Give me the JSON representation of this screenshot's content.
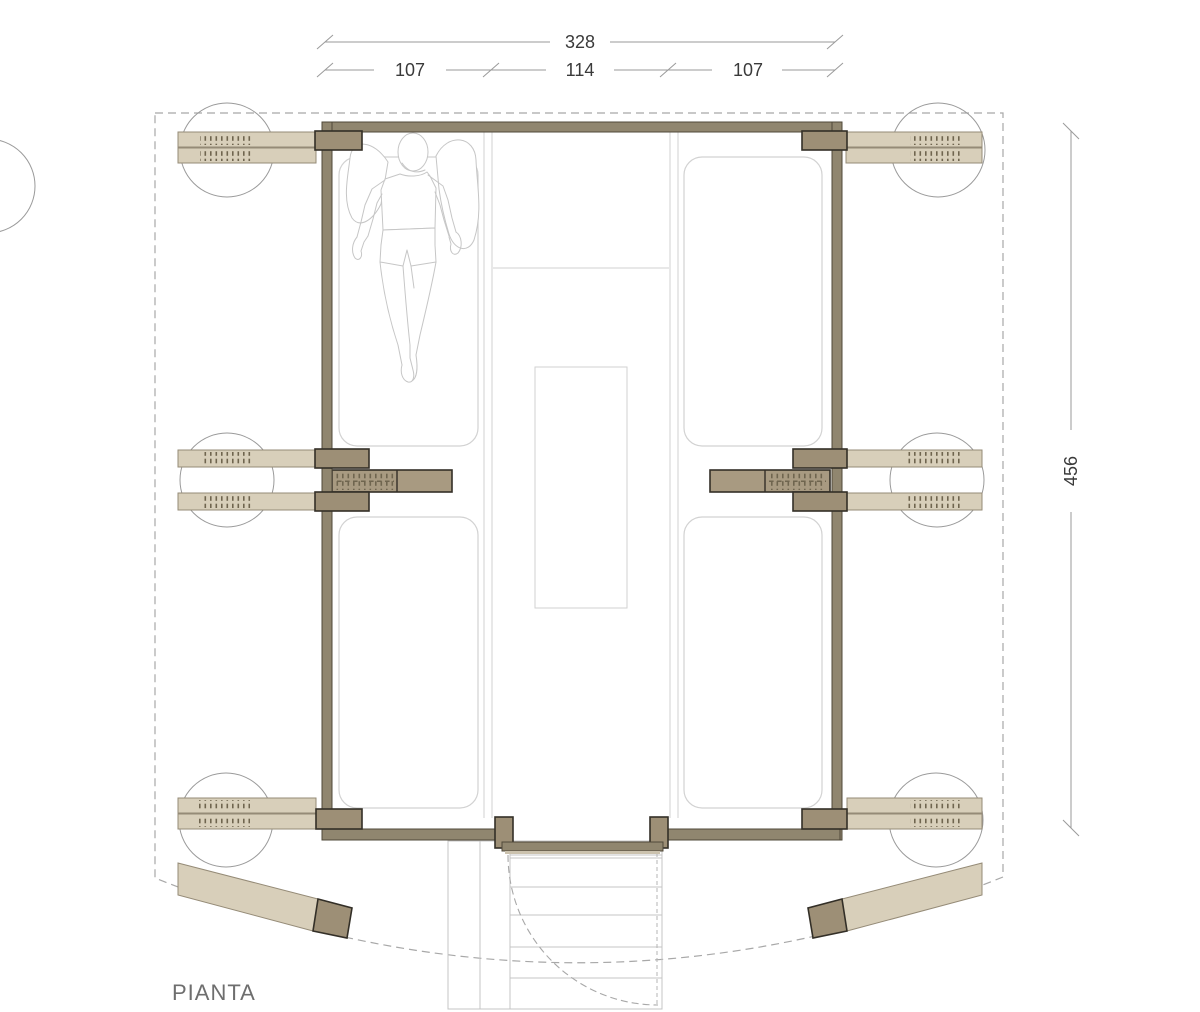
{
  "title": "PIANTA",
  "dimensions": {
    "total_width": "328",
    "segments": [
      "107",
      "114",
      "107"
    ],
    "height": "456"
  },
  "symbols": {
    "tree": "tree-canopy-circle",
    "person": "person-lying-on-mat-outline",
    "lashing": "beam-lashing-hatch-marks",
    "stairs": "entry-stair-treads",
    "door_swing": "dashed-door-swing-arc"
  },
  "colors": {
    "beam_fill": "#d8cfba",
    "beam_edge": "#958b77",
    "wall_fill": "#90866f",
    "wall_edge": "#4f4839",
    "block_fill": "#9d8f76",
    "block_edge": "#332f27",
    "innerbeam_fill": "#a89a81",
    "hatch_color": "#6f654f",
    "line_light": "#d2d2d2",
    "line_mid": "#9a9a9a",
    "dash_color": "#a8a8a8",
    "text_color": "#3a3a3a",
    "label_color": "#6e6e6e"
  }
}
